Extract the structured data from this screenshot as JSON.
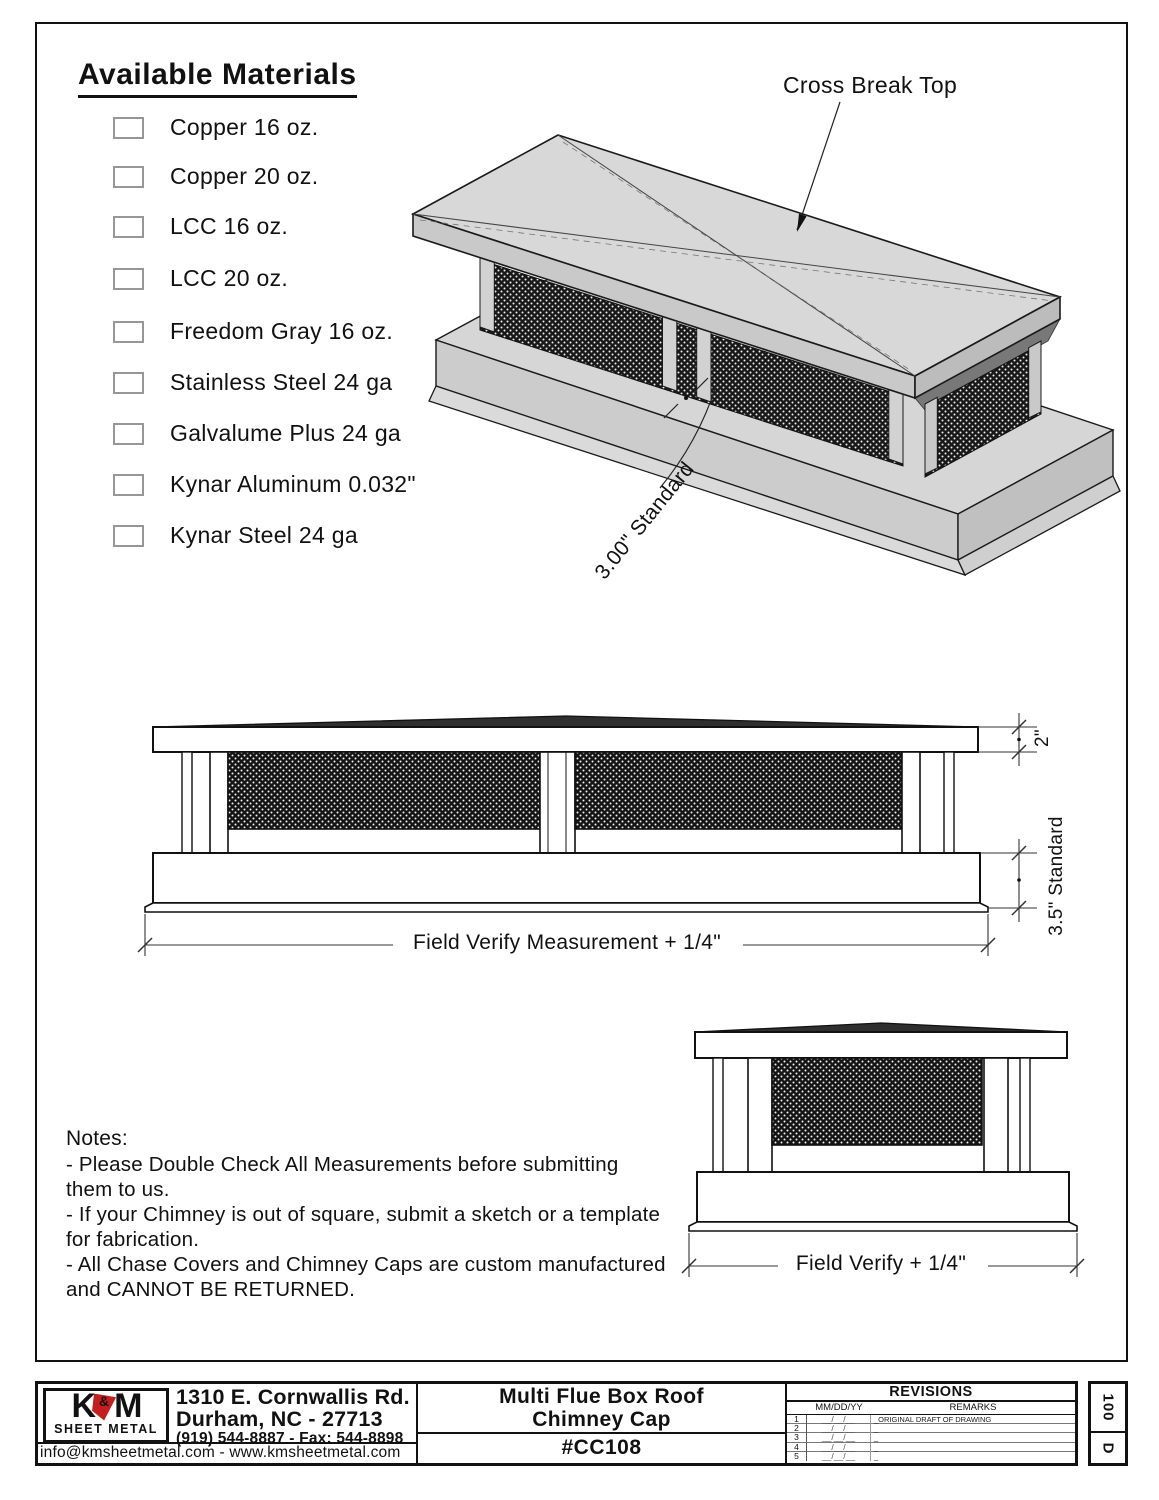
{
  "drawing": {
    "materials": {
      "title": "Available Materials",
      "items": [
        "Copper 16 oz.",
        "Copper 20 oz.",
        "LCC 16 oz.",
        "LCC 20 oz.",
        "Freedom Gray 16 oz.",
        "Stainless Steel 24 ga",
        "Galvalume Plus 24 ga",
        "Kynar Aluminum 0.032\"",
        "Kynar Steel 24 ga"
      ]
    },
    "annotations": {
      "cross_break": "Cross Break Top",
      "standard_3": "3.00\" Standard",
      "dim_2in": "2\"",
      "dim_35": "3.5\" Standard",
      "front_dim": "Field Verify Measurement + 1/4\"",
      "side_dim": "Field Verify + 1/4\""
    },
    "notes": {
      "title": "Notes:",
      "lines": [
        " - Please Double Check All Measurements before submitting them to us.",
        " - If your Chimney is out of square, submit a sketch or a template for fabrication.",
        " - All Chase Covers and Chimney Caps are custom manufactured and CANNOT BE RETURNED."
      ]
    }
  },
  "title_block": {
    "logo": {
      "k": "K",
      "amp": "&",
      "m": "M",
      "subtitle": "SHEET METAL"
    },
    "address_line1": "1310 E. Cornwallis Rd.",
    "address_line2": "Durham, NC - 27713",
    "phone": "(919) 544-8887 - Fax: 544-8898",
    "email_web": "info@kmsheetmetal.com - www.kmsheetmetal.com",
    "title_line1": "Multi Flue Box Roof",
    "title_line2": "Chimney Cap",
    "part_number": "#CC108",
    "revisions": {
      "header": "REVISIONS",
      "col_date": "MM/DD/YY",
      "col_remarks": "REMARKS",
      "rows": [
        {
          "num": "1",
          "date": "__/__/__",
          "remark": "_ORIGINAL DRAFT OF DRAWING"
        },
        {
          "num": "2",
          "date": "__/__/__",
          "remark": "_"
        },
        {
          "num": "3",
          "date": "__/__/__",
          "remark": "_"
        },
        {
          "num": "4",
          "date": "__/__/__",
          "remark": "_"
        },
        {
          "num": "5",
          "date": "__/__/__",
          "remark": "_"
        }
      ]
    },
    "sheet_code_top": "100",
    "sheet_code_bottom": "D"
  },
  "colors": {
    "line": "#111111",
    "accent_red": "#c41e1e",
    "mesh_dark": "#141414",
    "face_light": "#d8d8d8",
    "face_mid": "#c9c9c9",
    "face_dark": "#bcbcbc",
    "peak_dark": "#2f2f2f"
  }
}
